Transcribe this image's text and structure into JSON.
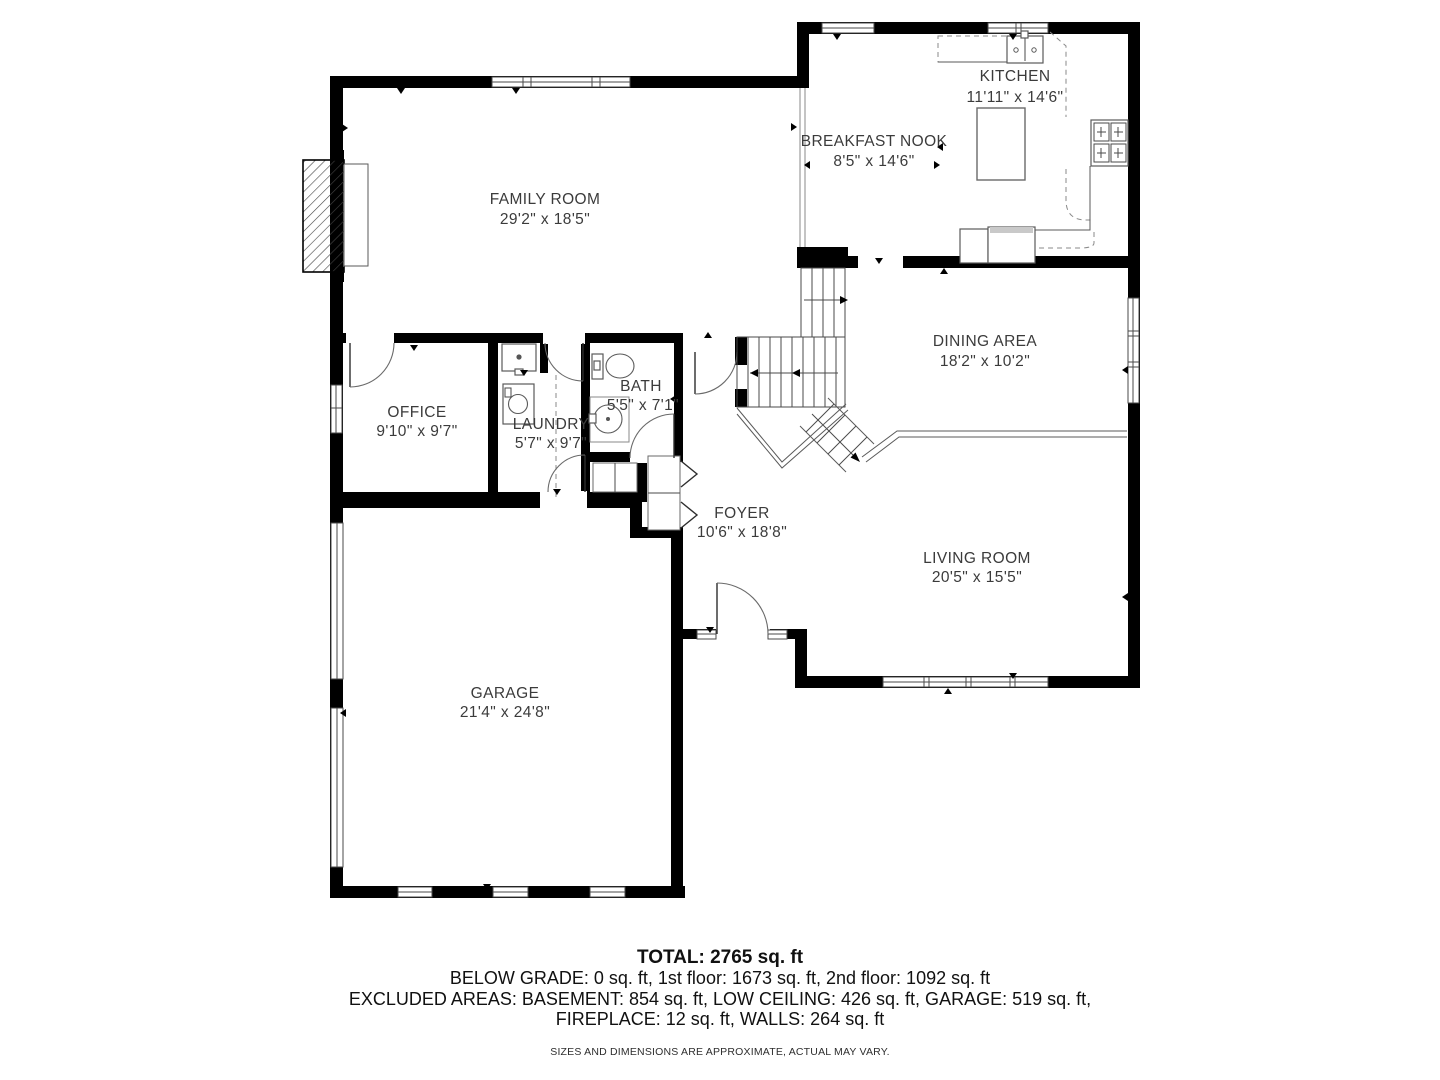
{
  "rooms": [
    {
      "id": "kitchen",
      "name": "KITCHEN",
      "dims": "11'11\" x 14'6\""
    },
    {
      "id": "breakfast-nook",
      "name": "BREAKFAST NOOK",
      "dims": "8'5\" x 14'6\""
    },
    {
      "id": "family-room",
      "name": "FAMILY ROOM",
      "dims": "29'2\" x 18'5\""
    },
    {
      "id": "dining-area",
      "name": "DINING AREA",
      "dims": "18'2\" x 10'2\""
    },
    {
      "id": "office",
      "name": "OFFICE",
      "dims": "9'10\" x 9'7\""
    },
    {
      "id": "laundry",
      "name": "LAUNDRY",
      "dims": "5'7\" x 9'7\""
    },
    {
      "id": "bath",
      "name": "BATH",
      "dims": "5'5\" x 7'1\""
    },
    {
      "id": "foyer",
      "name": "FOYER",
      "dims": "10'6\" x 18'8\""
    },
    {
      "id": "living-room",
      "name": "LIVING ROOM",
      "dims": "20'5\" x 15'5\""
    },
    {
      "id": "garage",
      "name": "GARAGE",
      "dims": "21'4\" x 24'8\""
    }
  ],
  "summary": {
    "total": "TOTAL: 2765 sq. ft",
    "line2": "BELOW GRADE: 0 sq. ft, 1st floor: 1673 sq. ft, 2nd floor: 1092 sq. ft",
    "line3": "EXCLUDED AREAS: BASEMENT: 854 sq. ft, LOW CEILING: 426 sq. ft, GARAGE: 519 sq. ft,",
    "line4": "FIREPLACE: 12 sq. ft, WALLS: 264 sq. ft",
    "disclaimer": "SIZES AND DIMENSIONS ARE APPROXIMATE, ACTUAL MAY VARY."
  },
  "colors": {
    "wall": "#000000",
    "label": "#3b3b3b",
    "thin_line": "#4a4a4a",
    "counter_dash": "#8a8a8a",
    "background": "#ffffff"
  }
}
